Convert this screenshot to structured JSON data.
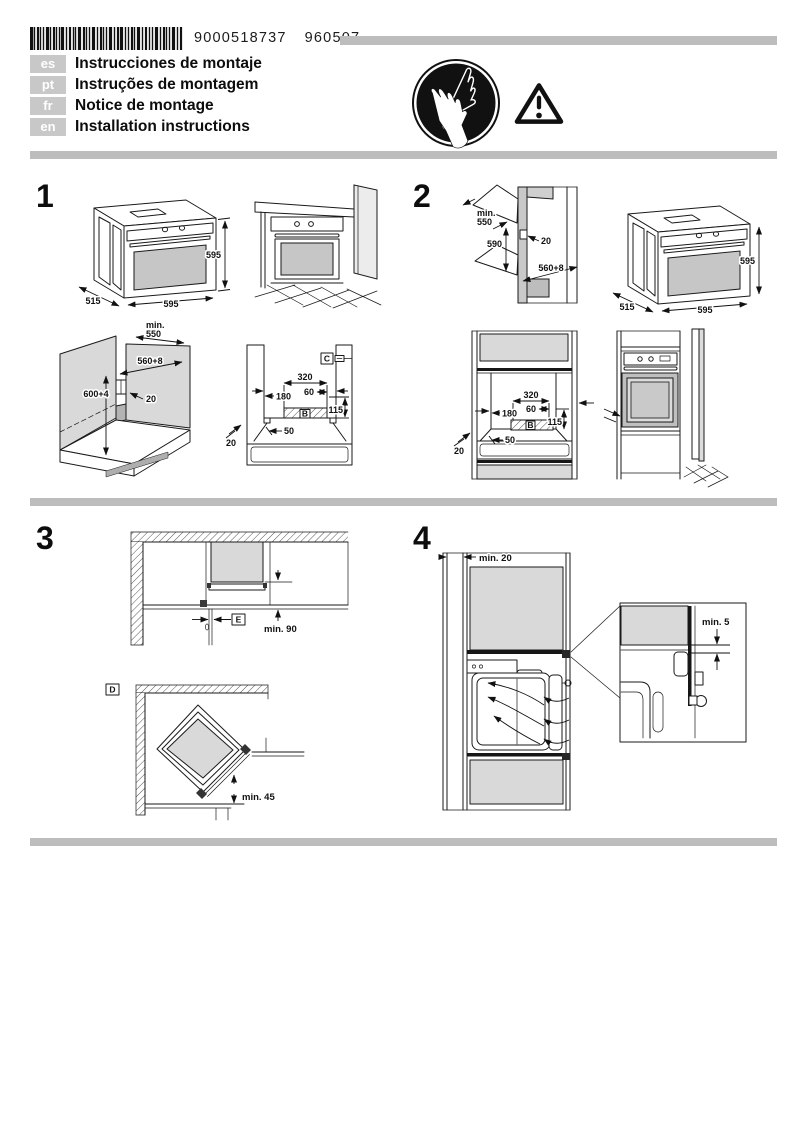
{
  "document": {
    "barcode_digits": "9000518737",
    "print_code": "960507"
  },
  "languages": [
    {
      "code": "es",
      "title": "Instrucciones de montaje"
    },
    {
      "code": "pt",
      "title": "Instruções de montagem"
    },
    {
      "code": "fr",
      "title": "Notice de montage"
    },
    {
      "code": "en",
      "title": "Installation instructions"
    }
  ],
  "icons": {
    "gloves_badge": "wear-protective-gloves",
    "warning_badge": "general-warning"
  },
  "sections": {
    "one": {
      "number": "1",
      "oven": {
        "height": "595",
        "width": "595",
        "depth": "515"
      },
      "cabinet": {
        "depth_label_1": "min.",
        "depth_label_2": "550",
        "width": "560+8",
        "height": "600+4",
        "gap": "20"
      },
      "cutout": {
        "clip": "C",
        "w320": "320",
        "w60": "60",
        "h180": "180",
        "zone": "B",
        "h115": "115",
        "d50": "50",
        "g20": "20"
      }
    },
    "two": {
      "number": "2",
      "niche": {
        "depth_label_1": "min.",
        "depth_label_2": "550",
        "height": "590",
        "gap": "20",
        "width": "560+8"
      },
      "oven": {
        "height": "595",
        "width": "595",
        "depth": "515"
      },
      "cutout": {
        "w320": "320",
        "w60": "60",
        "h180": "180",
        "zone": "B",
        "h115": "115",
        "d50": "50",
        "g20": "20"
      }
    },
    "three": {
      "number": "3",
      "corner_top": {
        "label": "E",
        "min90": "min. 90"
      },
      "corner_diagonal": {
        "label": "D",
        "min45": "min. 45"
      }
    },
    "four": {
      "number": "4",
      "min20": "min. 20",
      "min5": "min. 5"
    }
  }
}
